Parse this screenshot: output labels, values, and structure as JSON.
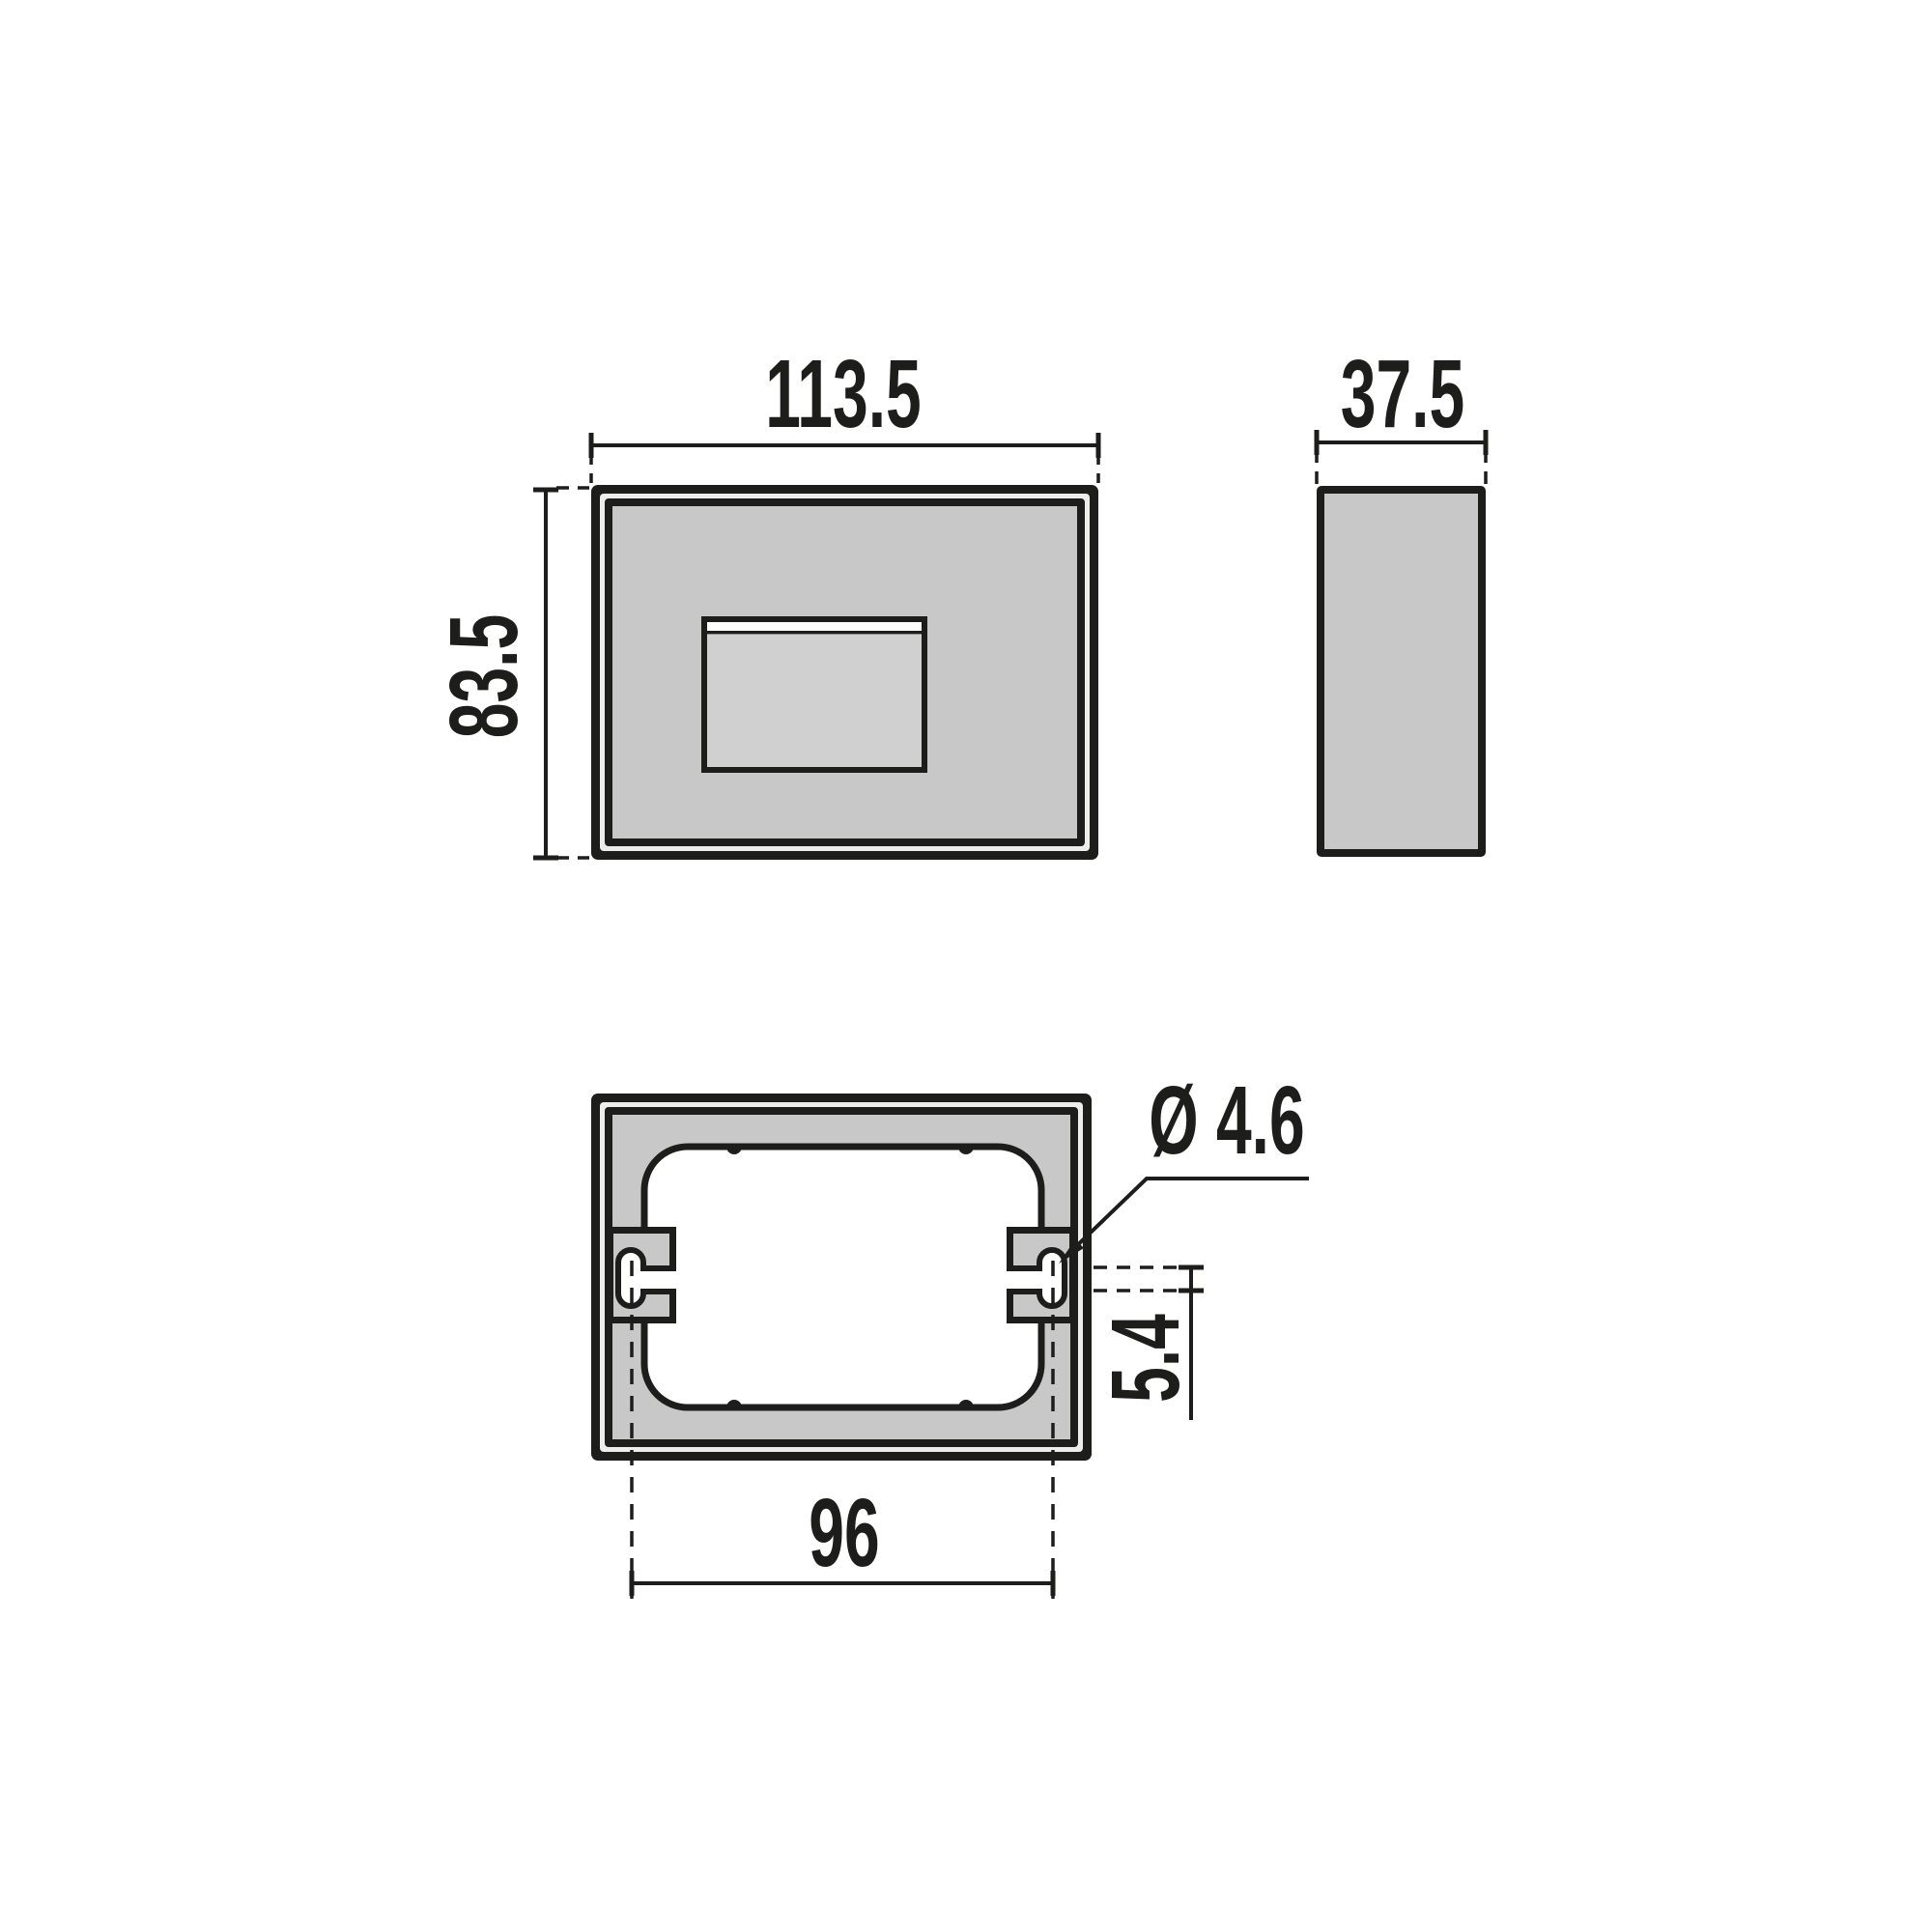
{
  "drawing": {
    "type": "technical-dimension-drawing",
    "background": "#ffffff",
    "line_color": "#1d1d1b",
    "body_fill": "#c8c8c8",
    "border_gap_fill": "#ededed",
    "window_fill": "#d0d0d0",
    "cutout_fill": "#ffffff",
    "views": {
      "front": {
        "label": "front-view"
      },
      "side": {
        "label": "side-view"
      },
      "back": {
        "label": "back-view-with-mounting-slots"
      }
    },
    "dimensions": {
      "front_width": "113.5",
      "front_height": "83.5",
      "side_depth": "37.5",
      "hole_diameter": "Ø 4.6",
      "slot_offset": "5.4",
      "mounting_spacing": "96"
    }
  }
}
